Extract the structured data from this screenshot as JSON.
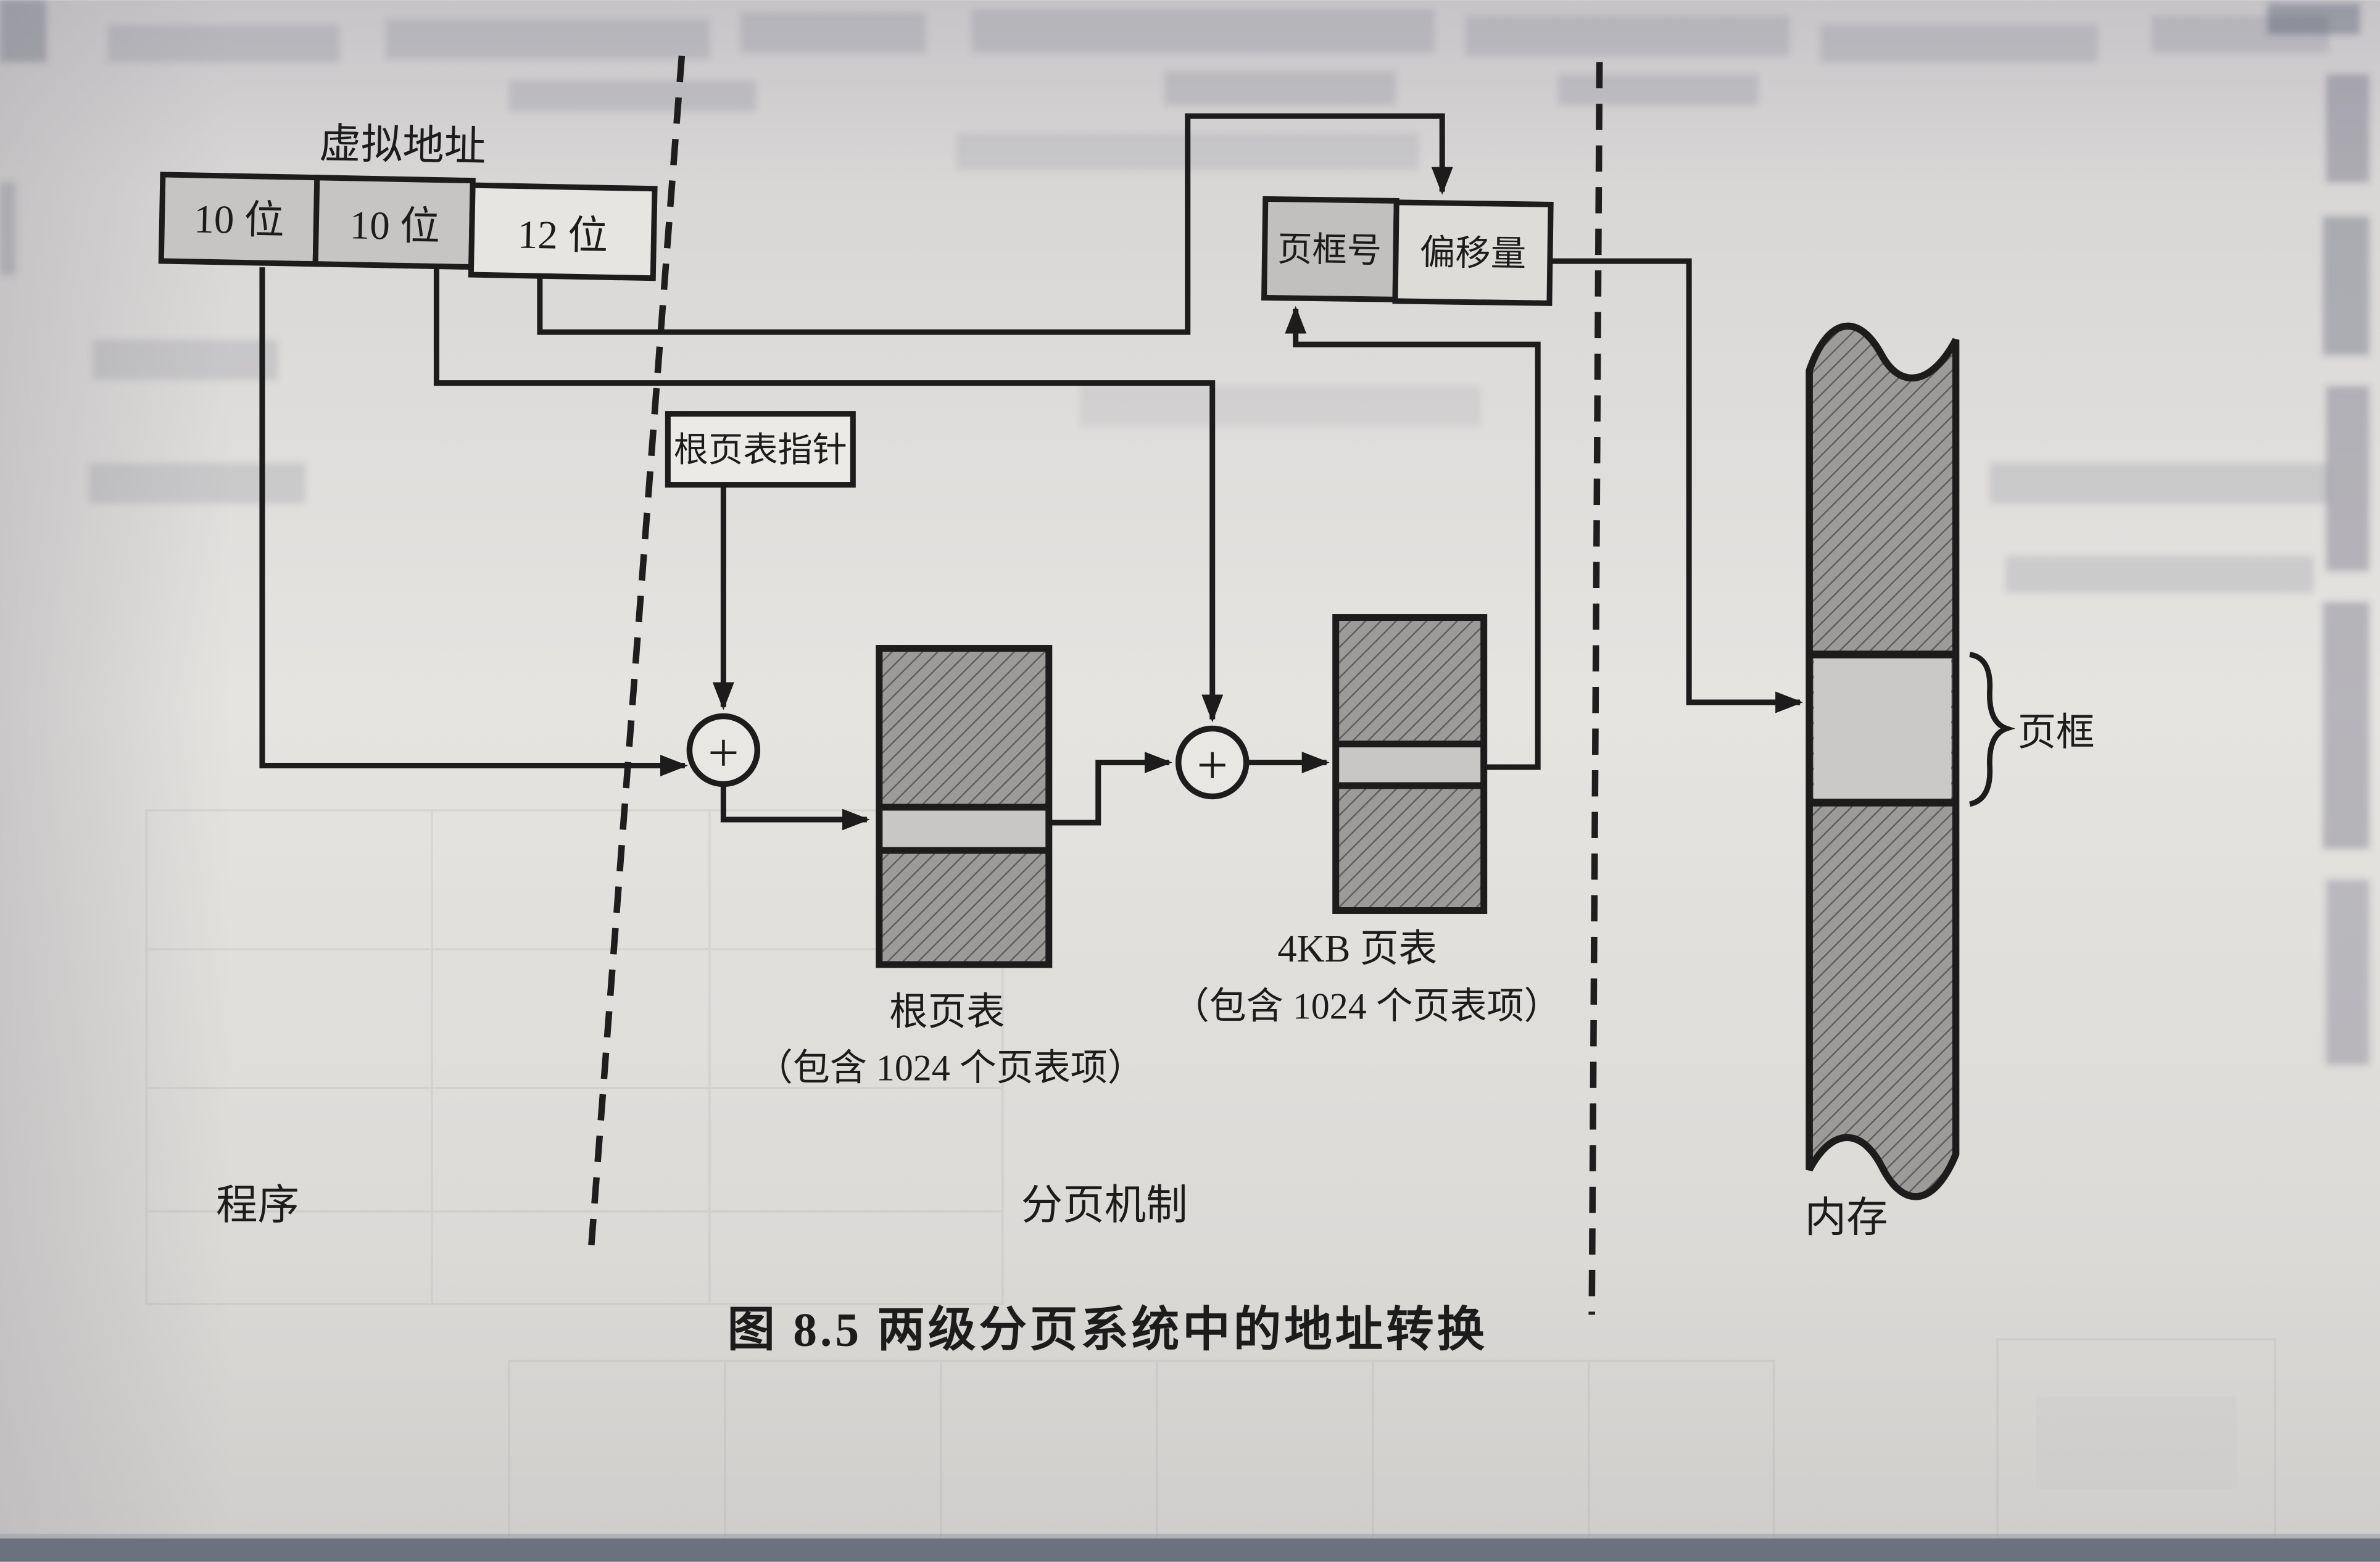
{
  "figure": {
    "caption": "图 8.5  两级分页系统中的地址转换",
    "virtual_address": {
      "label": "虚拟地址",
      "fields": [
        {
          "width_label": "10 位"
        },
        {
          "width_label": "10 位"
        },
        {
          "width_label": "12 位"
        }
      ]
    },
    "root_pointer": {
      "label": "根页表指针"
    },
    "adders": {
      "symbol": "+"
    },
    "root_table": {
      "name": "根页表",
      "note": "（包含 1024 个页表项）"
    },
    "page_table_4kb": {
      "name": "4KB 页表",
      "note": "（包含 1024 个页表项）"
    },
    "physical_address": {
      "frame": "页框号",
      "offset": "偏移量"
    },
    "memory": {
      "page_frame_label": "页框"
    },
    "regions": {
      "program": "程序",
      "paging": "分页机制",
      "memory": "内存"
    },
    "colors": {
      "ink": "#1c1c1c",
      "paper": "#e3e1df",
      "shaded_cell": "#c7c5c3",
      "hatch_fill": "#9d9b99",
      "light_band": "#c9c7c5"
    }
  }
}
